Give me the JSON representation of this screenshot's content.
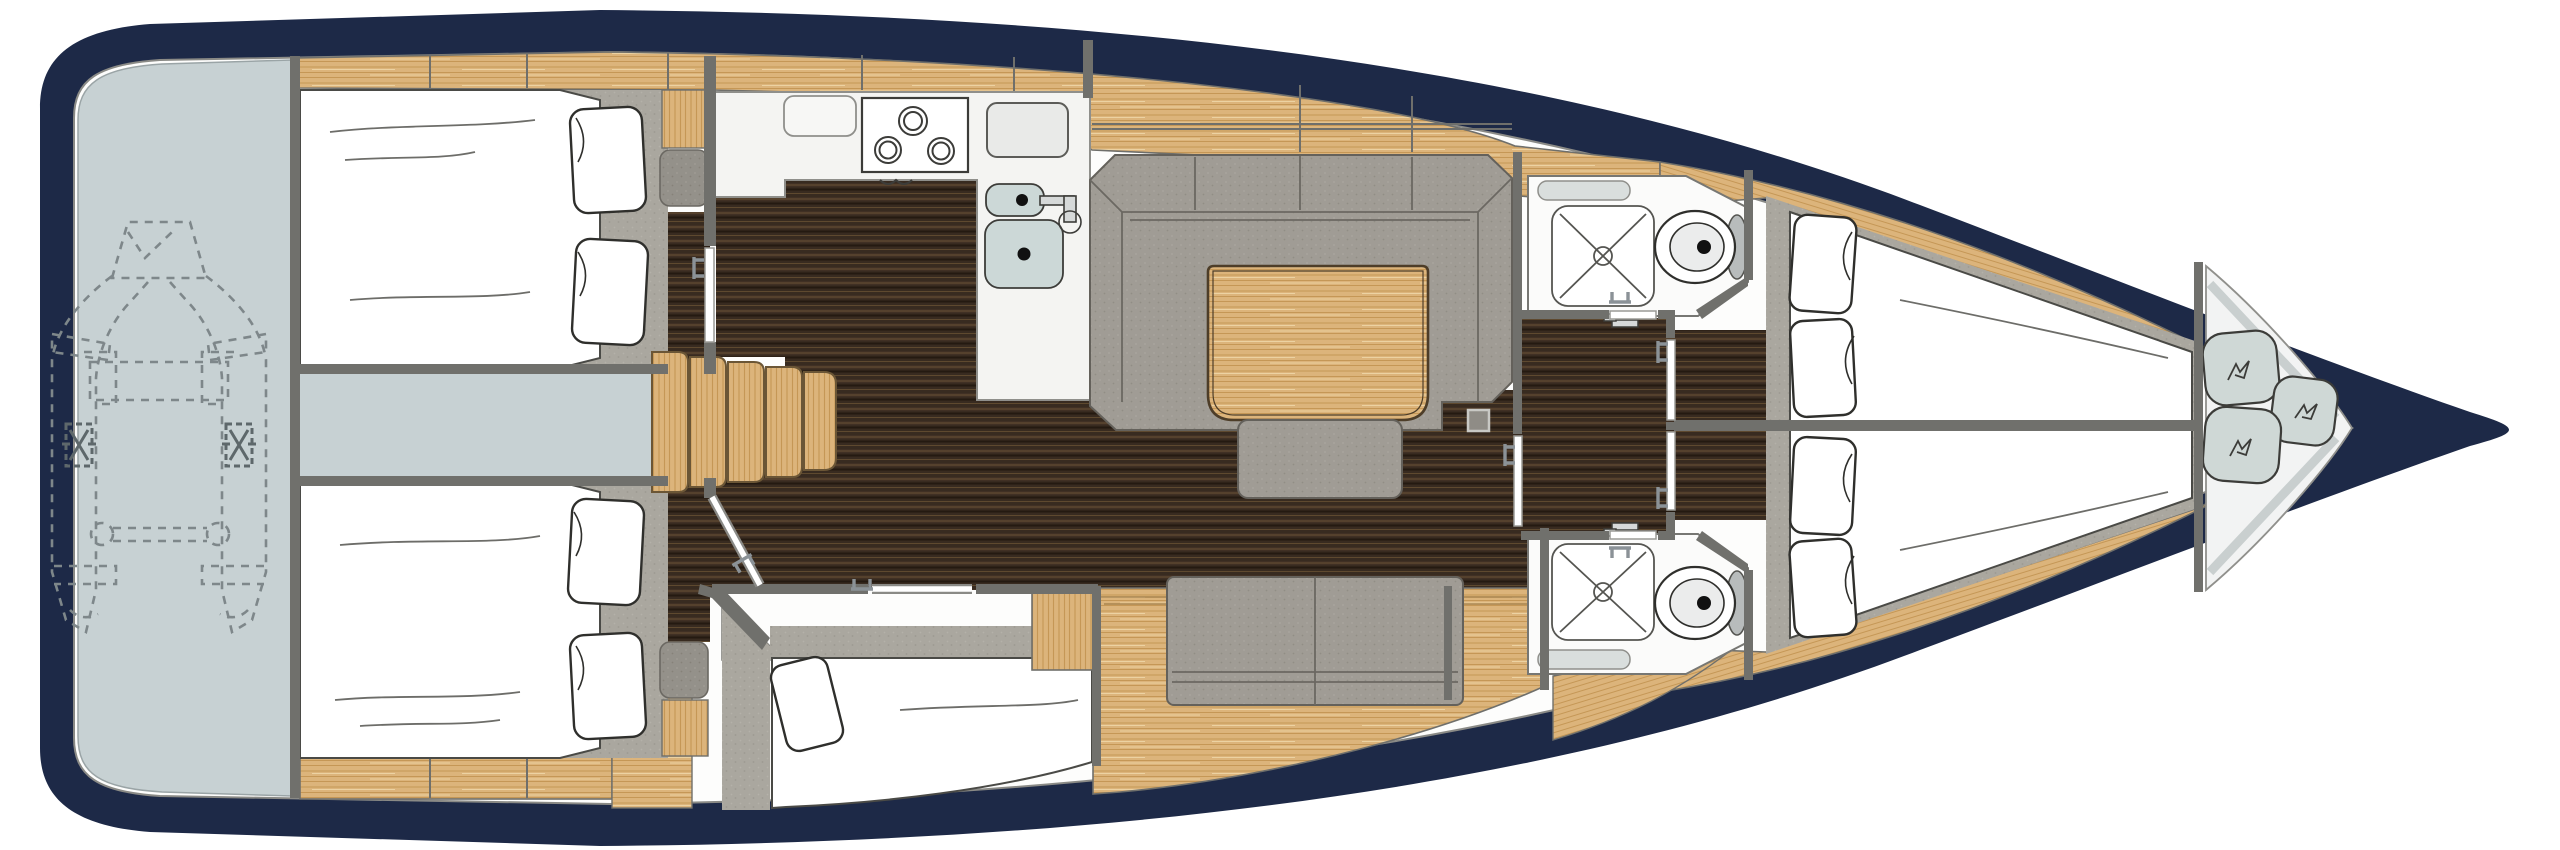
{
  "page": {
    "title": "Sailing yacht interior deck plan",
    "type": "floor-plan-illustration",
    "orientation": "bow-right-stern-left",
    "text_content": "none"
  },
  "colors": {
    "hull_navy": "#1d2947",
    "deck_white": "#fdfdfc",
    "platform_gray": "#c7d1d3",
    "wood": "#dcb47b",
    "wood_grain": "#c59756",
    "wood_table": "#e0ba82",
    "floor_dark": "#3a2d21",
    "floor_grain": "#55412d",
    "fabric_gray": "#a09c95",
    "carpet_gray": "#aaa79f",
    "seat_gray": "#94918a",
    "wall_gray": "#70706c",
    "room_white": "#fbfbfa",
    "counter_white": "#f4f4f2",
    "sink_gray": "#ccd8d7",
    "fixture_gray": "#b8bcbc",
    "cushion_gray": "#cfd8d6",
    "dinghy_dash": "#7e878a"
  },
  "regions": {
    "swim_platform": {
      "label": "Stern platform and tender garage with dinghy stowed (dashed outline)"
    },
    "dinghy": {
      "label": "Inflatable dinghy outline, dashed",
      "motor_mounts": 2,
      "towing_rings": 2
    },
    "aft_cabin_port": {
      "label": "Aft double cabin, port side",
      "pillows": 2,
      "door_state": "closed",
      "extras": [
        "seat",
        "locker"
      ]
    },
    "aft_cabin_starboard": {
      "label": "Aft double cabin, starboard side",
      "pillows": 2,
      "door_state": "open",
      "extras": [
        "seat",
        "locker"
      ]
    },
    "engine_compartment": {
      "label": "Engine compartment under cockpit between aft cabins"
    },
    "companionway": {
      "label": "Companionway steps down to salon",
      "steps": 5
    },
    "galley": {
      "label": "Galley, port side",
      "stove_burners": 3,
      "sinks": 2,
      "fridge": 1,
      "faucet": 1
    },
    "salon": {
      "label": "Salon",
      "settee": "U-shaped settee port",
      "table": "wood dining table",
      "bench": "bench seat at table",
      "sofa": "two-seat sofa starboard",
      "mast_post": 1
    },
    "mid_cabin": {
      "label": "Mid single-berth cabin, starboard aft of salon",
      "pillows": 1,
      "door_state": "open"
    },
    "head_port": {
      "label": "Bathroom port side",
      "shower": 1,
      "toilet": 1,
      "sink": 1
    },
    "head_starboard": {
      "label": "Bathroom starboard side",
      "shower": 1,
      "toilet": 1,
      "sink": 1
    },
    "corridor": {
      "label": "Corridor between bathrooms to forward cabins",
      "doors": 3
    },
    "forward_cabin_port": {
      "label": "Forward double cabin, port side",
      "pillows": 2
    },
    "forward_cabin_starboard": {
      "label": "Forward double cabin, starboard side",
      "pillows": 2
    },
    "forepeak": {
      "label": "Forepeak sail locker",
      "cushions": 3
    }
  }
}
